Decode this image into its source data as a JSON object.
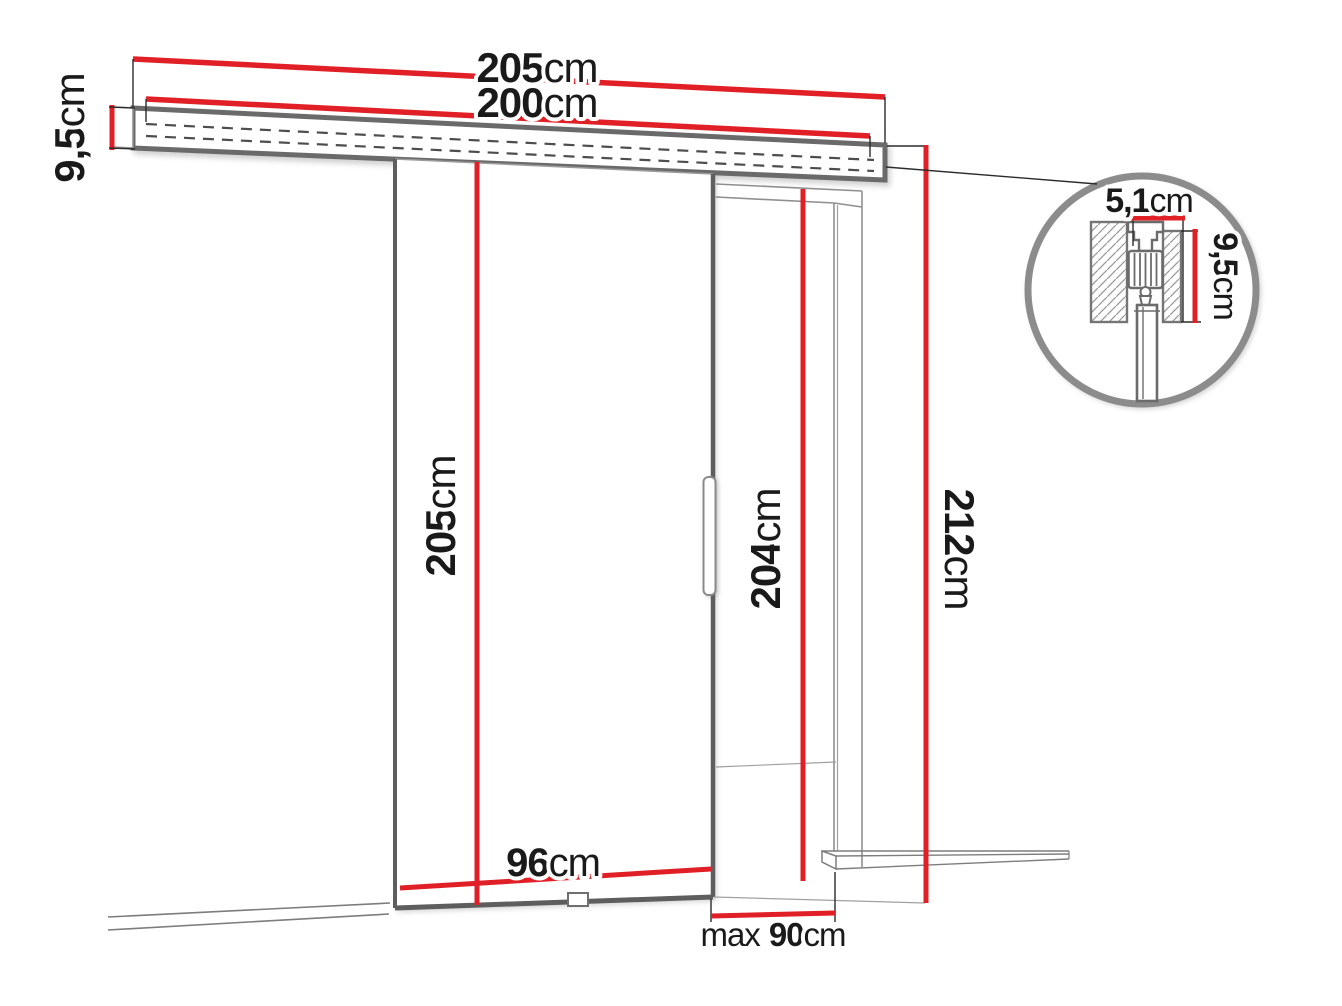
{
  "diagram": {
    "type": "sliding-door-dimension-drawing",
    "colors": {
      "dimension_red": "#e02026",
      "outline_gray": "#6a6a6a",
      "label_black": "#1a1a1a"
    },
    "labels": {
      "rail_total_length": {
        "value": "205",
        "unit": "cm"
      },
      "rail_track_length": {
        "value": "200",
        "unit": "cm"
      },
      "rail_profile_height": {
        "value": "9,5",
        "unit": "cm"
      },
      "door_height": {
        "value": "205",
        "unit": "cm"
      },
      "door_width": {
        "value": "96",
        "unit": "cm"
      },
      "opening_height": {
        "value": "204",
        "unit": "cm"
      },
      "total_height": {
        "value": "212",
        "unit": "cm"
      },
      "opening_width": {
        "prefix": "max",
        "value": "90",
        "unit": "cm"
      },
      "detail_width": {
        "value": "5,1",
        "unit": "cm"
      },
      "detail_height": {
        "value": "9,5",
        "unit": "cm"
      }
    }
  }
}
